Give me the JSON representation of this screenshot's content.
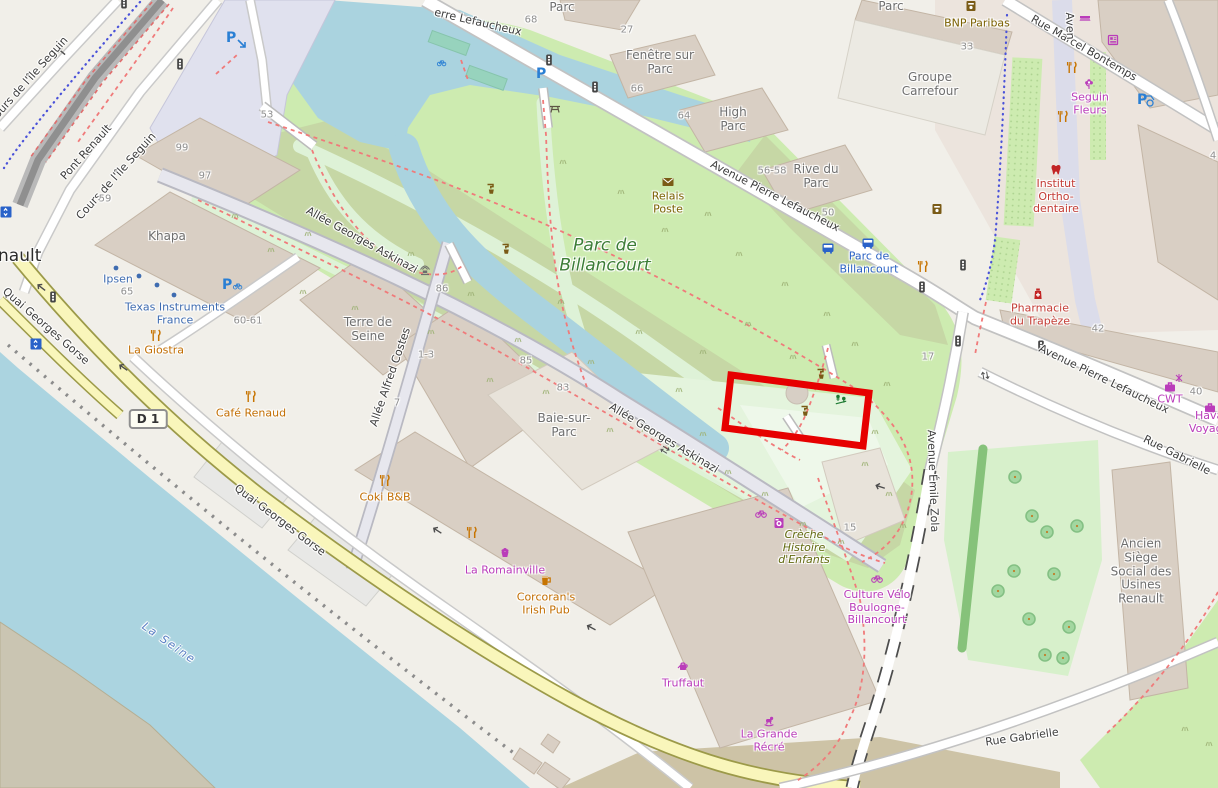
{
  "map_style": "openstreetmap-carto",
  "highlight": {
    "shape": "rectangle",
    "color": "#e60000",
    "location": "clearing with playground inside Parc de Billancourt"
  },
  "labels": {
    "streets": [
      "Cours de l'île Seguin",
      "Pont Renault",
      "Cours de l'île Seguin",
      "erre Lefaucheux",
      "Avenue Pierre Lefaucheux",
      "Rue Marcel Bontemps",
      "Aven",
      "Avenue Pierre Lefaucheux",
      "Rue Gabrielle",
      "Rue Gabrielle",
      "Avenue Émile Zola",
      "Allée Georges Askinazi",
      "Allée Georges Askinazi",
      "Allée Alfred Costes",
      "Quai Georges Gorse",
      "Quai Georges Gorse"
    ],
    "places": [
      "Khapa",
      "Terre de Seine",
      "Baie-sur-Parc",
      "Fenêtre sur Parc",
      "High Parc",
      "Rive du Parc",
      "Groupe Carrefour",
      "Parc",
      "Parc",
      "Ancien Siège Social des Usines Renault",
      "nault",
      "Ipsen",
      "Texas Instruments France"
    ],
    "park": "Parc de Billancourt",
    "water": "La Seine",
    "bus_stop": "Parc de Billancourt",
    "road_shield": "D 1",
    "house_numbers": [
      "99",
      "97",
      "59",
      "53",
      "65",
      "60-61",
      "86",
      "85",
      "83",
      "1-3",
      "7",
      "27",
      "66",
      "64",
      "68",
      "56-58",
      "50",
      "33",
      "42",
      "40",
      "4",
      "17",
      "15"
    ],
    "pois": [
      {
        "name": "La Giostra",
        "kind": "restaurant"
      },
      {
        "name": "Café Renaud",
        "kind": "restaurant"
      },
      {
        "name": "Coki B&B",
        "kind": "restaurant"
      },
      {
        "name": "Corcoran's Irish Pub",
        "kind": "pub"
      },
      {
        "name": "La Romainville",
        "kind": "bakery"
      },
      {
        "name": "Truffaut",
        "kind": "garden-centre"
      },
      {
        "name": "La Grande Récré",
        "kind": "toy-shop"
      },
      {
        "name": "Culture Vélo Boulogne- Billancourt",
        "kind": "bicycle-shop"
      },
      {
        "name": "Crèche Histoire d'Enfants",
        "kind": "childcare"
      },
      {
        "name": "Relais Poste",
        "kind": "post-office"
      },
      {
        "name": "BNP Paribas",
        "kind": "bank"
      },
      {
        "name": "Seguin Fleurs",
        "kind": "florist"
      },
      {
        "name": "Institut Ortho- dentaire",
        "kind": "dentist"
      },
      {
        "name": "Pharmacie du Trapèze",
        "kind": "pharmacy"
      },
      {
        "name": "CWT",
        "kind": "travel-agency"
      },
      {
        "name": "Havas Voyages",
        "kind": "travel-agency"
      }
    ]
  },
  "icon_legend": {
    "restaurant": "fork-knife",
    "pub": "beer-mug",
    "bakery": "cupcake",
    "garden-centre": "watering-can",
    "toy-shop": "rocking-horse",
    "bicycle-shop": "bicycle",
    "post-office": "envelope",
    "bank": "atm",
    "florist": "flower",
    "dentist": "tooth",
    "pharmacy": "medicine-bottle",
    "travel-agency": "briefcase",
    "playground": "figures",
    "drinking-water": "tap",
    "parking": "blue-P",
    "bus-stop": "bus",
    "traffic-signal": "traffic-light",
    "elevator": "up-down-arrows",
    "fountain": "spray",
    "picnic": "picnic-table"
  },
  "colors": {
    "water": "#aad3df",
    "grass": "#cdebb0",
    "scrub": "#c6d7a5",
    "road": "#ffffff",
    "trunk": "#f9f6bb",
    "building": "#d9cfc4",
    "highlight": "#e60000",
    "path": "#f07a7a",
    "cycle_route": "#4a52d9"
  }
}
